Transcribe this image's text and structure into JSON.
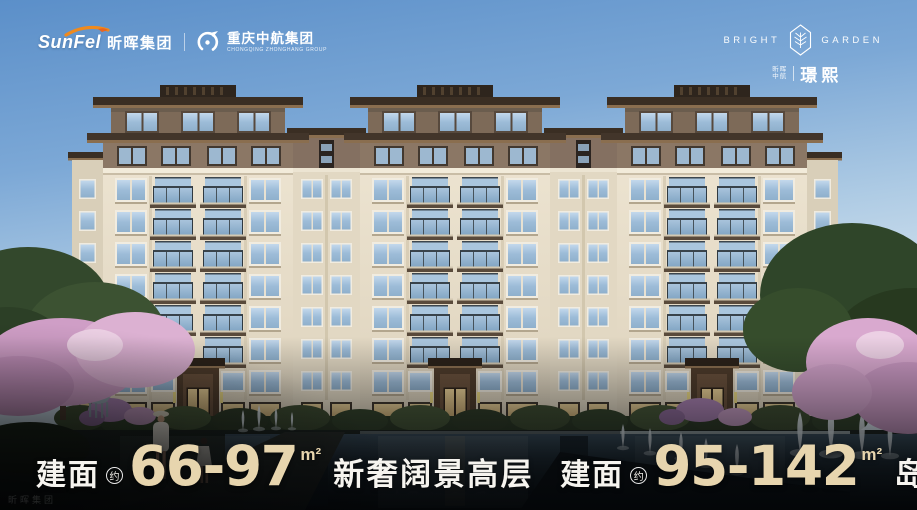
{
  "header": {
    "left": {
      "sunfel_en": "SunFel",
      "sunfel_cn": "昕晖集团",
      "partner_cn": "重庆中航集团",
      "partner_en": "CHONGQING ZHONGHANG GROUP"
    },
    "right": {
      "en_left": "BRIGHT",
      "en_right": "GARDEN",
      "owner_line1": "昕晖",
      "owner_line2": "中航",
      "project_name": "璟熙"
    }
  },
  "footer": {
    "segments": [
      {
        "label": "建面",
        "approx": "约",
        "range": "66-97",
        "unit": "m²",
        "slogan": "新奢阔景高层"
      },
      {
        "label": "建面",
        "approx": "约",
        "range": "95-142",
        "unit": "m²",
        "slogan": "岛岸揽景洋房"
      }
    ],
    "watermark": "昕晖集团"
  },
  "colors": {
    "accent_gold": "#e7d5ae",
    "swoosh_orange": "#f08a1d",
    "sky_top": "#5b8fc9",
    "text_white": "#f6f4ef"
  },
  "scene": {
    "description": "Rendering of a 10-storey cream residential building with brown penthouse levels, three roofed towers, blue glass balconies, cherry-blossom trees, fountains and a dark reflecting pool"
  }
}
